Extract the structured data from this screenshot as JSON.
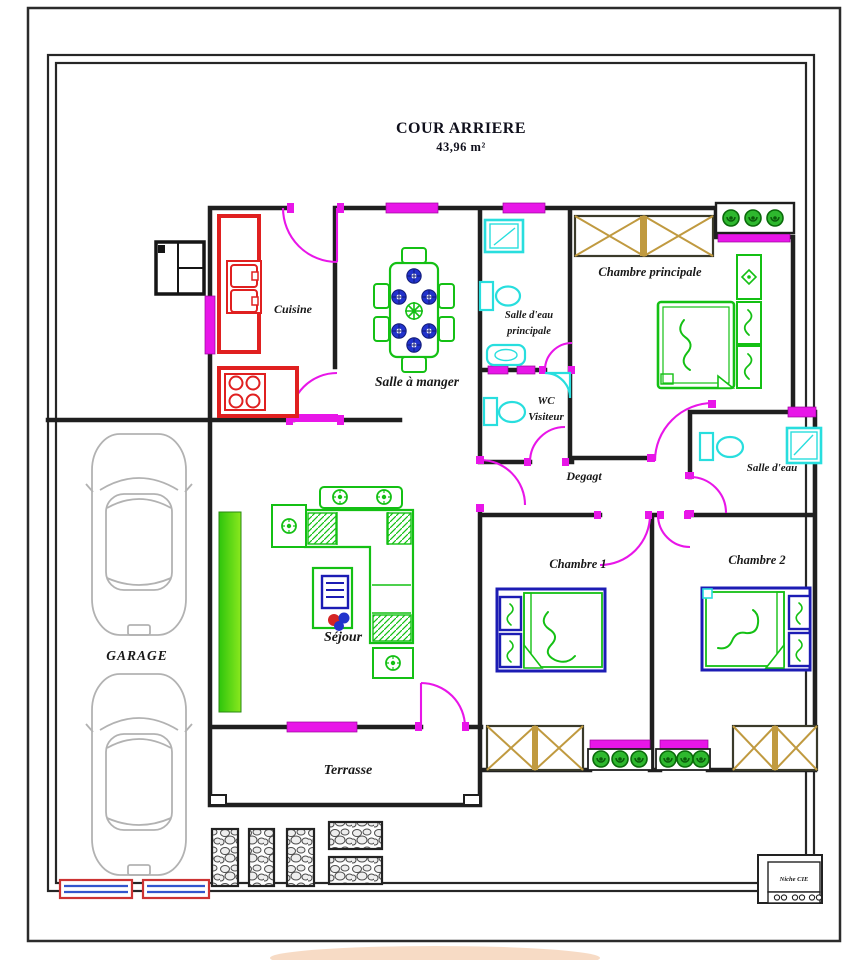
{
  "title": {
    "main": "COUR ARRIERE",
    "area": "43,96 m²"
  },
  "rooms": {
    "cuisine": {
      "label": "Cuisine"
    },
    "salle_a_manger": {
      "label": "Salle à manger"
    },
    "salle_eau_principale": {
      "line1": "Salle d'eau",
      "line2": "principale"
    },
    "chambre_principale": {
      "label": "Chambre principale"
    },
    "wc_visiteur": {
      "line1": "WC",
      "line2": "Visiteur"
    },
    "degagement": {
      "label": "Degagt"
    },
    "salle_eau": {
      "label": "Salle d'eau"
    },
    "chambre_1": {
      "label": "Chambre 1"
    },
    "chambre_2": {
      "label": "Chambre 2"
    },
    "sejour": {
      "label": "Séjour"
    },
    "terrasse": {
      "label": "Terrasse"
    },
    "garage": {
      "label": "GARAGE"
    }
  },
  "annotations": {
    "niche": "Niche CIE"
  },
  "colors": {
    "wall": "#1f1f1f",
    "opening": "#e816e8",
    "kitchen": "#e02020",
    "sanitary": "#28dede",
    "furniture": "#14c014",
    "bed_frame": "#1c1cb4",
    "wardrobe": "#c09a40",
    "plant": "#2eb82e",
    "car": "#b2b2b2",
    "planter": "#46d90f",
    "flower_red": "#d42525",
    "flower_blue": "#2233cc"
  }
}
